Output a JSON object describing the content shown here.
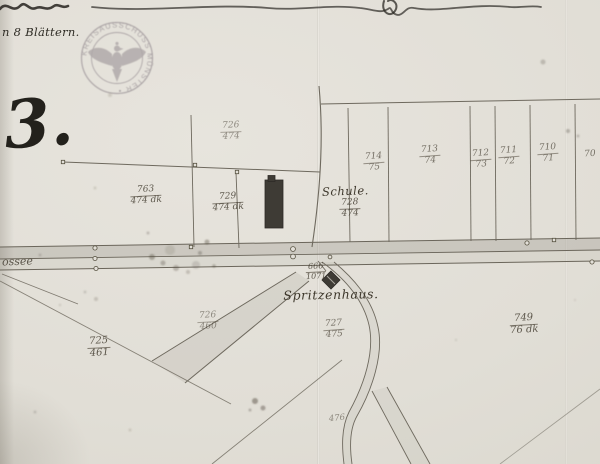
{
  "sheet_number": "3.",
  "note": "n 8 Blättern.",
  "stamp": {
    "ring_text": "KREISAUSSCHUSS MÜNSTER •",
    "emblem": "prussian-eagle"
  },
  "road_label": "ossee",
  "buildings": {
    "schule": "Schule.",
    "spritzenhaus": "Spritzenhaus."
  },
  "parcels": [
    {
      "num": "726",
      "den": "474"
    },
    {
      "num": "763",
      "den": "474 dk"
    },
    {
      "num": "729",
      "den": "474 dk"
    },
    {
      "num": "728",
      "den": "474"
    },
    {
      "num": "714",
      "den": "75"
    },
    {
      "num": "713",
      "den": "74"
    },
    {
      "num": "712",
      "den": "73"
    },
    {
      "num": "711",
      "den": "72"
    },
    {
      "num": "710",
      "den": "71"
    },
    {
      "num": "70",
      "den": ""
    },
    {
      "num": "666",
      "den": "1071"
    },
    {
      "num": "725",
      "den": "461"
    },
    {
      "num": "726",
      "den": "460"
    },
    {
      "num": "727",
      "den": "475"
    },
    {
      "num": "749",
      "den": "76 dk"
    },
    {
      "num": "476",
      "den": ""
    }
  ]
}
